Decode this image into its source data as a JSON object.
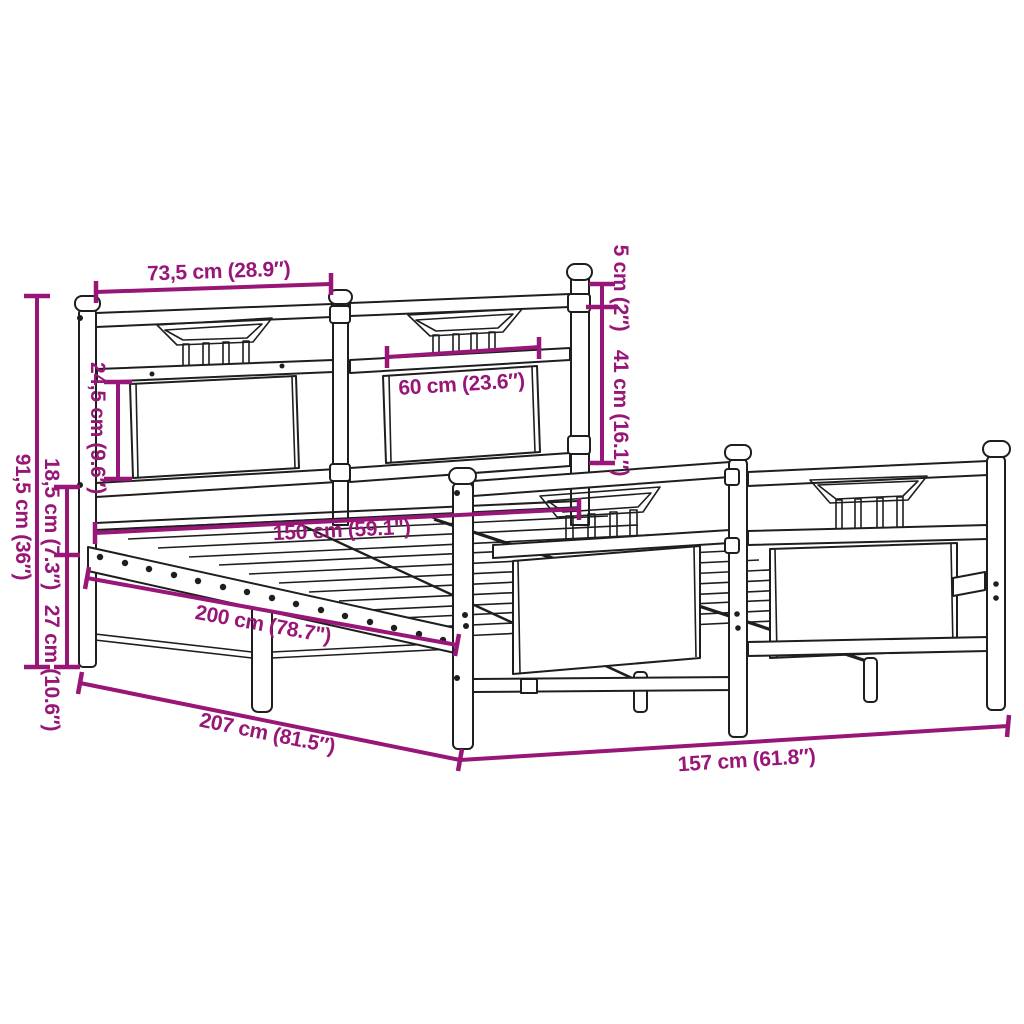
{
  "diagram": {
    "subject": "metal bed frame with headboard and footboard, perspective line drawing with dimension callouts",
    "units": "cm and inches"
  },
  "colors": {
    "dimension_accent": "#981677",
    "outline": "#1e1e1e",
    "background": "#ffffff"
  },
  "labels": {
    "headboard_bay_width": "73,5 cm (28.9″)",
    "headboard_panel_height": "24,5 cm (9.6″)",
    "headboard_height": "91,5 cm (36″)",
    "side_rail_height": "18,5 cm (7.3″)",
    "platform_clearance": "27 cm (10.6″)",
    "post_above_rail": "5 cm (2″)",
    "footboard_height": "41 cm (16.1″)",
    "panel_width": "60 cm (23.6″)",
    "inner_width": "150 cm (59.1\")",
    "inner_length": "200 cm (78.7\")",
    "outer_length": "207 cm (81.5″)",
    "outer_width": "157 cm (61.8″)"
  }
}
